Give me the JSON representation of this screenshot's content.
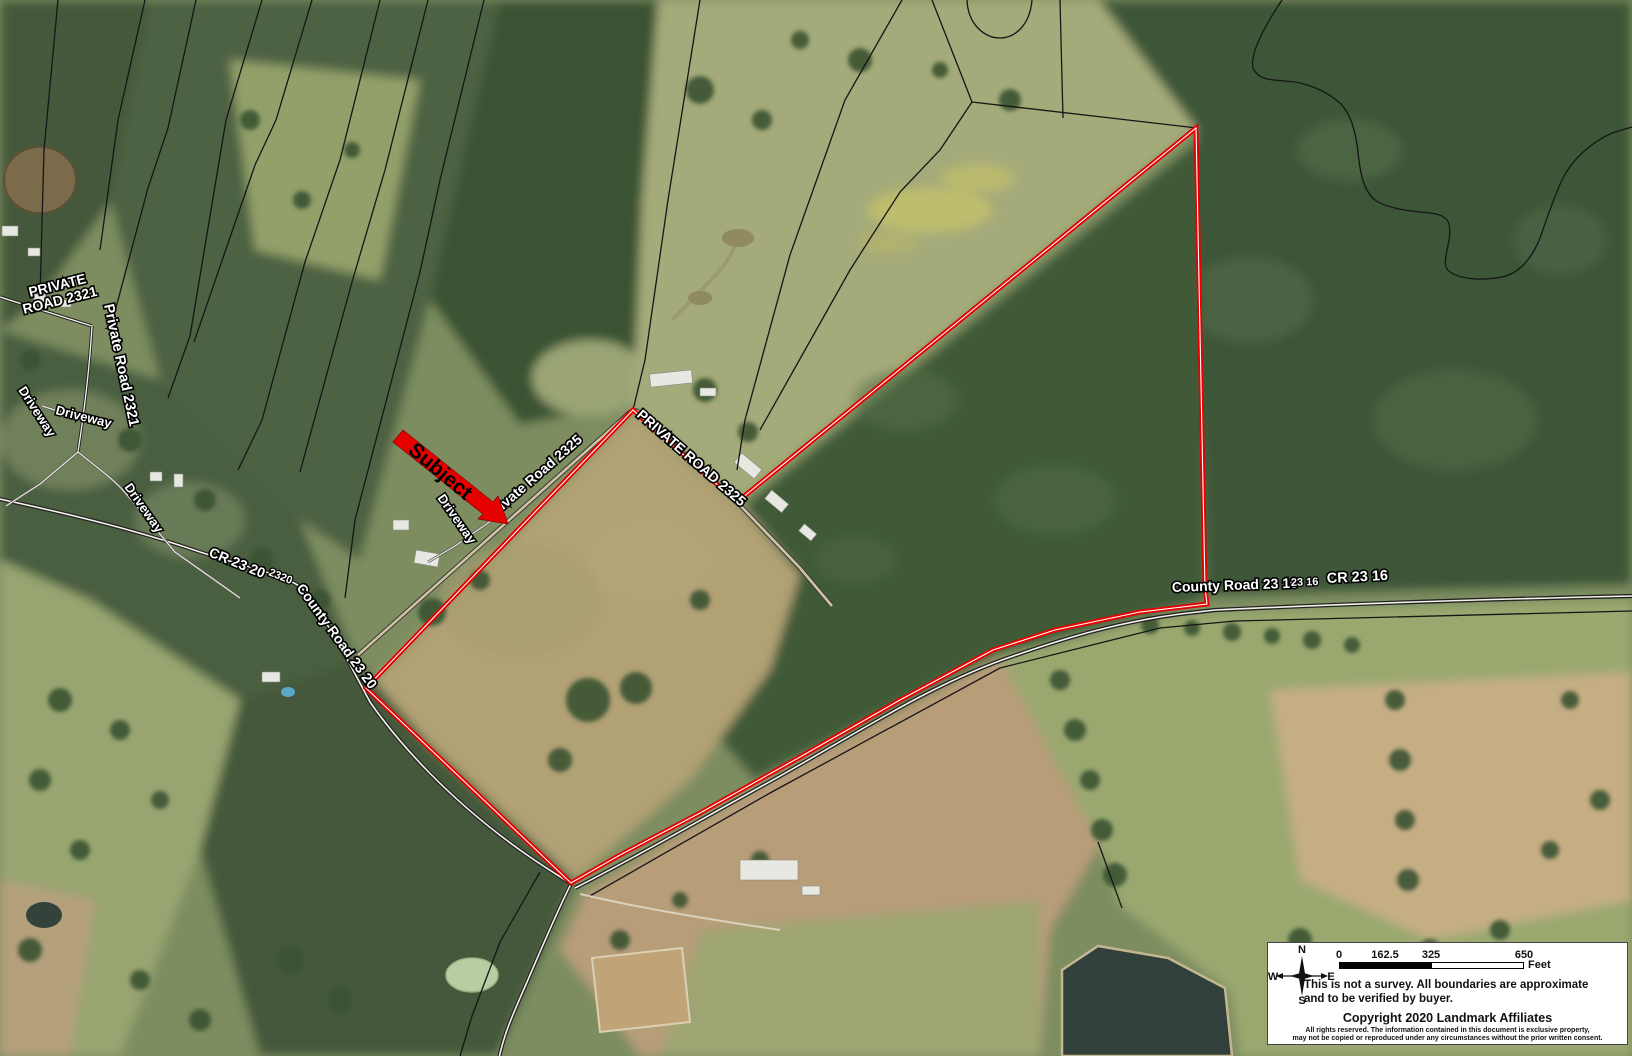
{
  "map": {
    "road_labels": {
      "private_road_2321_caps_line1": "PRIVATE",
      "private_road_2321_caps_line2": "ROAD 2321",
      "private_road_2321": "Private Road 2321",
      "driveway": "Driveway",
      "cr_23_20": "CR 23 20",
      "cr_23_20_short": "2320",
      "county_road_23_20": "County Road 23 20",
      "private_road_2325": "Private Road 2325",
      "private_road_2325_caps": "PRIVATE ROAD 2325",
      "county_road_23_16": "County Road 23 16",
      "cr_23_16_short": "23 16",
      "cr_23_16": "CR 23 16"
    },
    "subject_arrow_label": "Subject",
    "boundary_color": "#e60000"
  },
  "legend": {
    "scale_ticks": {
      "t0": "0",
      "t1": "162.5",
      "t2": "325",
      "t3": "650"
    },
    "unit": "Feet",
    "compass": {
      "n": "N",
      "s": "S",
      "e": "E",
      "w": "W"
    },
    "disclaimer_line1": "This is not a survey.  All boundaries are approximate",
    "disclaimer_line2": "and to be verified by buyer.",
    "copyright": "Copyright 2020 Landmark Affiliates",
    "fine_print_line1": "All rights reserved. The information contained in this document is exclusive property,",
    "fine_print_line2": "may not be copied or reproduced under any circumstances without the prior written consent."
  }
}
